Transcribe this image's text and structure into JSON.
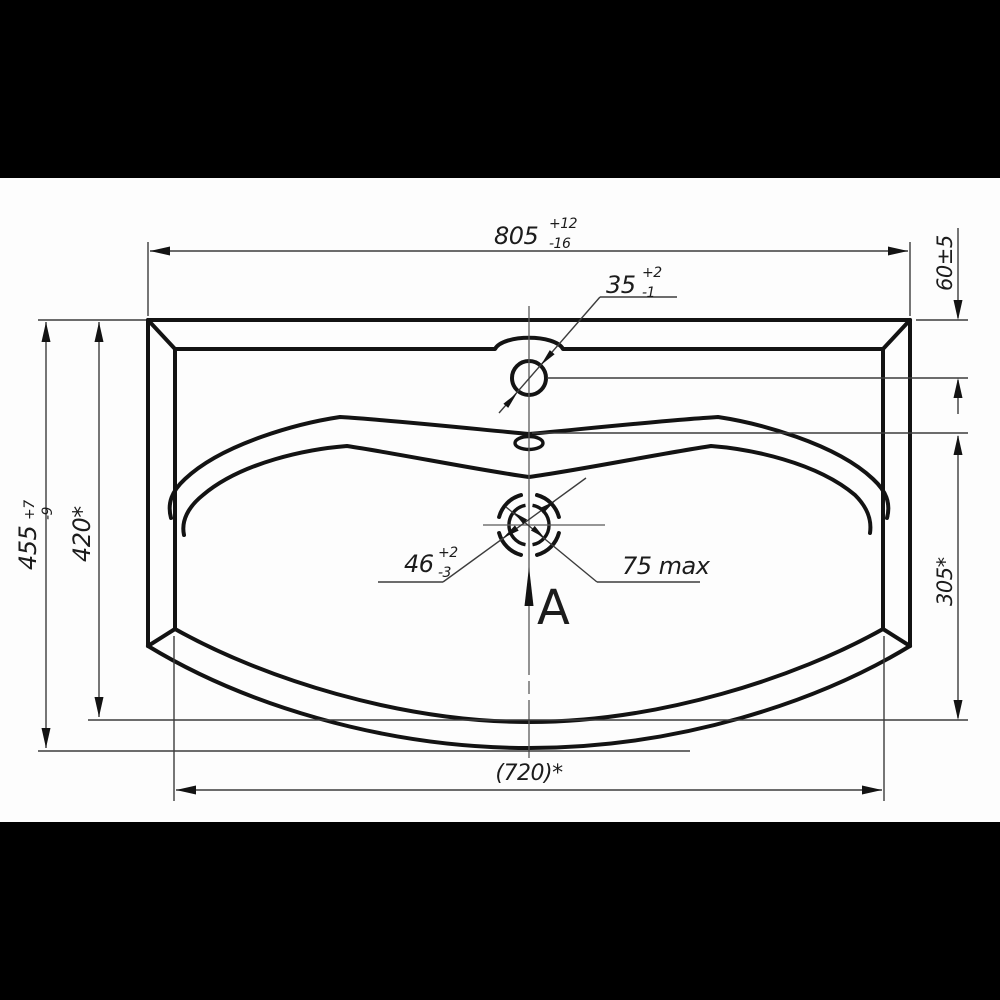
{
  "document": {
    "type": "Technical dimension drawing of a washbasin (top view)",
    "sheet_color": "#fdfdfd",
    "letterbox_color": "#000000",
    "line_color": "#131313"
  },
  "dimensions": {
    "overall_width": {
      "value": "805",
      "tol_upper": "+12",
      "tol_lower": "-16"
    },
    "faucet_hole": {
      "value": "35",
      "tol_upper": "+2",
      "tol_lower": "-1"
    },
    "back_offset": {
      "value": "60±5"
    },
    "overall_depth": {
      "value": "455",
      "tol_upper": "+7",
      "tol_lower": "-9"
    },
    "inner_depth": {
      "value": "420*"
    },
    "drain_hole": {
      "value": "46",
      "tol_upper": "+2",
      "tol_lower": "-3"
    },
    "drain_recess": {
      "value": "75 max"
    },
    "ledge_to_front": {
      "value": "305*"
    },
    "inner_width": {
      "value": "(720)*"
    },
    "view_label": {
      "value": "A"
    }
  }
}
